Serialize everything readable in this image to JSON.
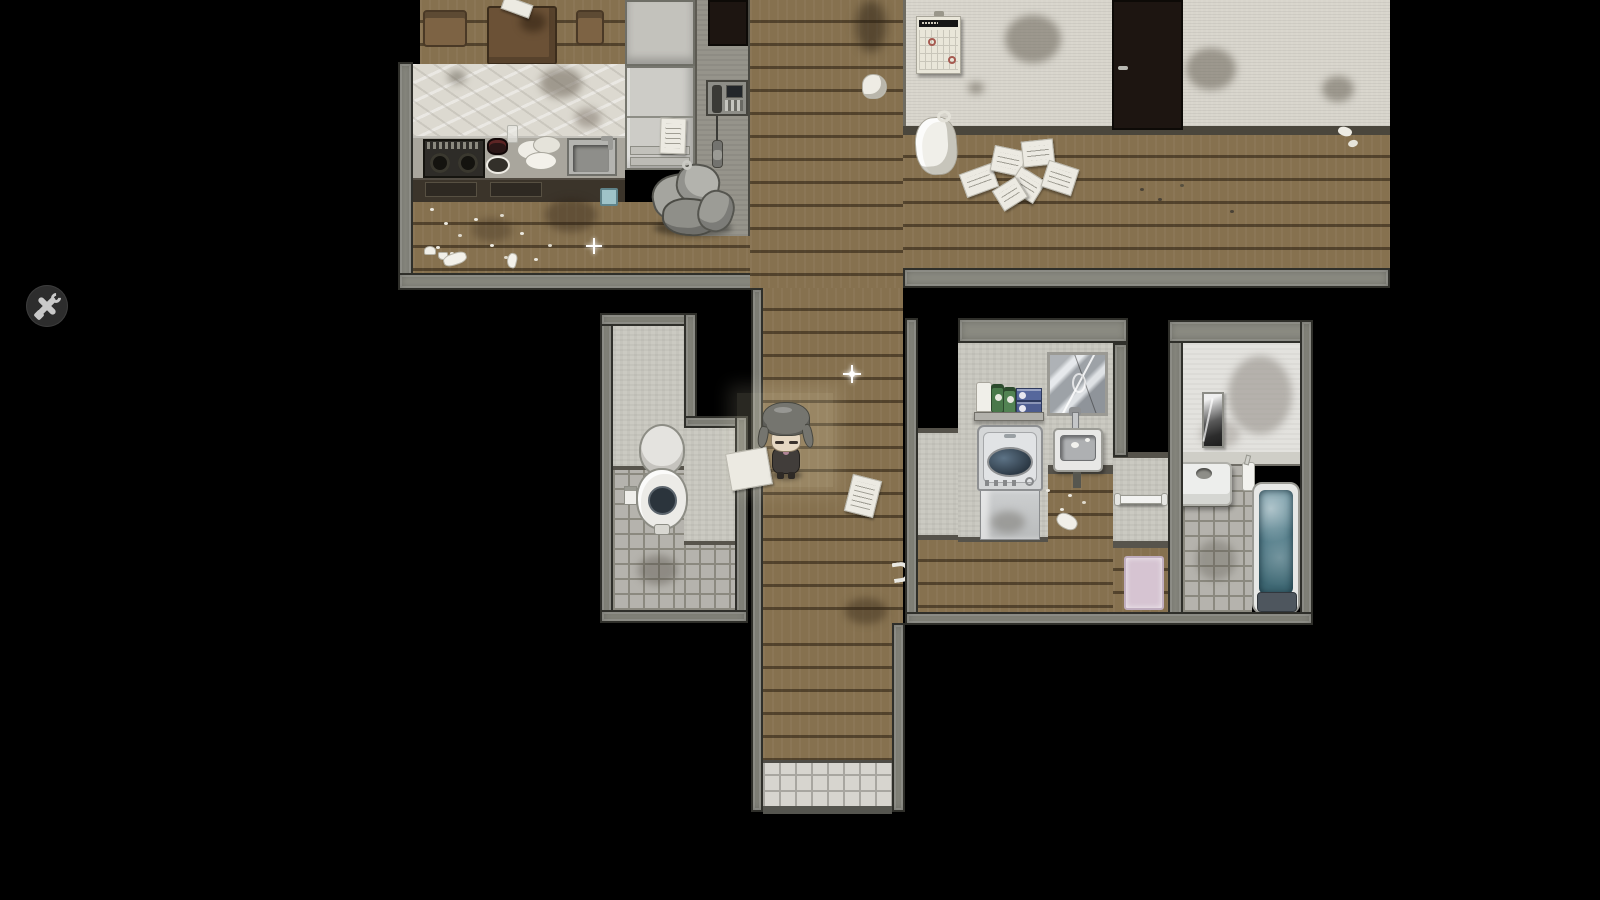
{
  "ui": {
    "settings_button": {
      "icon": "wrench-screwdriver-icon",
      "shape": "circle",
      "bg": "#2d2d2d",
      "icon_color": "#c9c9c9"
    }
  },
  "scene": {
    "type": "top-down-rpg-apartment-interior",
    "background": "#000000",
    "palette": {
      "bg": "#000000",
      "wood": "#86714f",
      "wall": "#8a8a81",
      "walldark": "#2f2f2a",
      "iwall": "#cbcac2",
      "whitewall": "#d8d5cc",
      "bathwall": "#e3e2de",
      "tile": "#b5b3ad",
      "grout": "#8b897f",
      "entrytile": "#d7d5cf",
      "marble": "#dcd9d0",
      "counter": "#a9a69d",
      "cabinet": "#3b342a",
      "fridge": "#cdccc7",
      "darkdoor": "#1d1511",
      "calpaper": "#e9e6d9",
      "calheader": "#161616",
      "calmark": "#a65a50",
      "water": "#527e8b",
      "tub": "#e7e8e6",
      "tubbase": "#4e565e",
      "washer": "#d4d6d7",
      "glass": "#33434f",
      "mat": "#d6c4d2",
      "green": "#49784a",
      "blue": "#56679c",
      "hair": "#75756f",
      "skin": "#e6d8c2",
      "outfit": "#413d3a",
      "btn": "#2d2d2d",
      "btnicon": "#c9c9c9"
    },
    "rooms": [
      {
        "name": "kitchen-dining",
        "objects": [
          "dining-table",
          "chair-left",
          "chair-right",
          "paper-on-table",
          "stove",
          "cooking-pot",
          "glass-cup",
          "dirty-dishes",
          "kitchen-sink",
          "blue-bin",
          "refrigerator",
          "fridge-note",
          "wall-cabinet",
          "intercom-phone",
          "dark-doorway",
          "garbage-bag-pile",
          "food-scraps",
          "floor-stains"
        ]
      },
      {
        "name": "upper-hallway",
        "objects": [
          "wall-calendar",
          "calendar-marks",
          "dark-door",
          "white-trash-bag",
          "scattered-papers",
          "crumpled-paper",
          "wall-stains",
          "floor-debris"
        ]
      },
      {
        "name": "corridor",
        "objects": [
          "player-character",
          "paper-under-character",
          "dropped-note",
          "sparkle-item-floor",
          "sparkle-item-kitchen",
          "warm-light-patch",
          "entry-tile-step"
        ]
      },
      {
        "name": "toilet-room",
        "objects": [
          "toilet",
          "toilet-paper-holder",
          "tiled-floor",
          "interior-walls"
        ]
      },
      {
        "name": "laundry-room",
        "objects": [
          "washing-machine",
          "wall-sink",
          "faucet",
          "shelf",
          "paper-towels",
          "detergent-bottles-green",
          "detergent-boxes-blue",
          "cracked-mirror",
          "open-dark-door",
          "white-wall-hook",
          "floor-debris"
        ]
      },
      {
        "name": "bathroom",
        "objects": [
          "bathtub",
          "bath-water",
          "tub-step",
          "tall-mirror",
          "toilet-paper-box",
          "shampoo-bottle",
          "towel-bar",
          "pink-bath-mat",
          "tiled-floor",
          "wall-smudges"
        ]
      }
    ],
    "character": {
      "description": "gray-haired chibi sprite facing down, dark outfit",
      "location": "corridor"
    }
  }
}
